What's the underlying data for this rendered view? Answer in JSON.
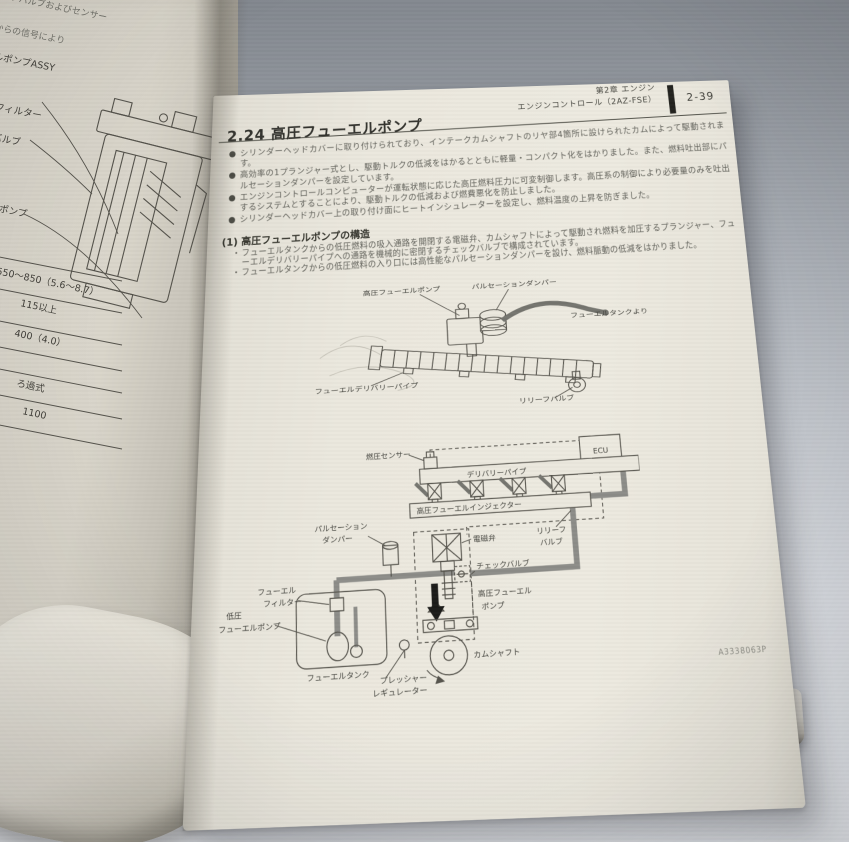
{
  "colors": {
    "paper": "#ebe8de",
    "ink": "#3b3b36",
    "background_top": "#82878e",
    "background_bottom": "#e2e5e9",
    "pipe_gray": "#8d8d89"
  },
  "left_page": {
    "fragment_line1": "トオフバルブおよびセンサー",
    "fragment_line2": "からの信号により",
    "pump_assy_label": "フューエルポンプASSY",
    "callout_filter": "エルフィルター",
    "callout_valve": "バルブ",
    "callout_pump": "エルポンプ",
    "table_values": [
      "550〜850（5.6〜8.7）",
      "115以上",
      "400（4.0）",
      "ろ過式",
      "1100"
    ]
  },
  "right_page": {
    "header": {
      "chapter": "第2章 エンジン",
      "section": "エンジンコントロール（2AZ-FSE）",
      "page_number": "2-39"
    },
    "title": "2.24 高圧フューエルポンプ",
    "bullet_glyph": "●",
    "sub_bullet_glyph": "・",
    "bullets": [
      "シリンダーヘッドカバーに取り付けられており、インテークカムシャフトのリヤ部4箇所に設けられたカムによって駆動されます。",
      "高効率の1プランジャー式とし、駆動トルクの低減をはかるとともに軽量・コンパクト化をはかりました。また、燃料吐出部にパルセーションダンパーを設定しています。",
      "エンジンコントロールコンピューターが運転状態に応じた高圧燃料圧力に可変制御します。高圧系の制御により必要量のみを吐出するシステムとすることにより、駆動トルクの低減および燃費悪化を防止しました。",
      "シリンダーヘッドカバー上の取り付け面にヒートインシュレーターを設定し、燃料温度の上昇を防ぎました。"
    ],
    "structure_heading": "(1) 高圧フューエルポンプの構造",
    "structure_bullets": [
      "フューエルタンクからの低圧燃料の吸入通路を開閉する電磁弁、カムシャフトによって駆動され燃料を加圧するプランジャー、フューエルデリバリーパイプへの通路を機械的に密閉するチェックバルブで構成されています。",
      "フューエルタンクからの低圧燃料の入り口には高性能なパルセーションダンパーを設け、燃料脈動の低減をはかりました。"
    ],
    "figure1": {
      "hp_pump": "高圧フューエルポンプ",
      "pulsation_damper": "パルセーションダンパー",
      "from_tank": "フューエルタンクより",
      "delivery_pipe": "フューエルデリバリーパイプ",
      "relief_valve": "リリーフバルブ"
    },
    "figure2": {
      "pressure_sensor": "燃圧センサー",
      "ecu": "ECU",
      "delivery_pipe": "デリバリーパイプ",
      "injector": "高圧フューエルインジェクター",
      "pulsation_damper_l1": "パルセーション",
      "pulsation_damper_l2": "ダンパー",
      "solenoid_valve": "電磁弁",
      "relief_valve_l1": "リリーフ",
      "relief_valve_l2": "バルブ",
      "check_valve": "チェックバルブ",
      "filter_l1": "フューエル",
      "filter_l2": "フィルター",
      "lp_pump_l1": "低圧",
      "lp_pump_l2": "フューエルポンプ",
      "hp_pump_l1": "高圧フューエル",
      "hp_pump_l2": "ポンプ",
      "fuel_tank": "フューエルタンク",
      "camshaft": "カムシャフト",
      "regulator_l1": "プレッシャー",
      "regulator_l2": "レギュレーター"
    },
    "figure_code": "A3338063P"
  }
}
